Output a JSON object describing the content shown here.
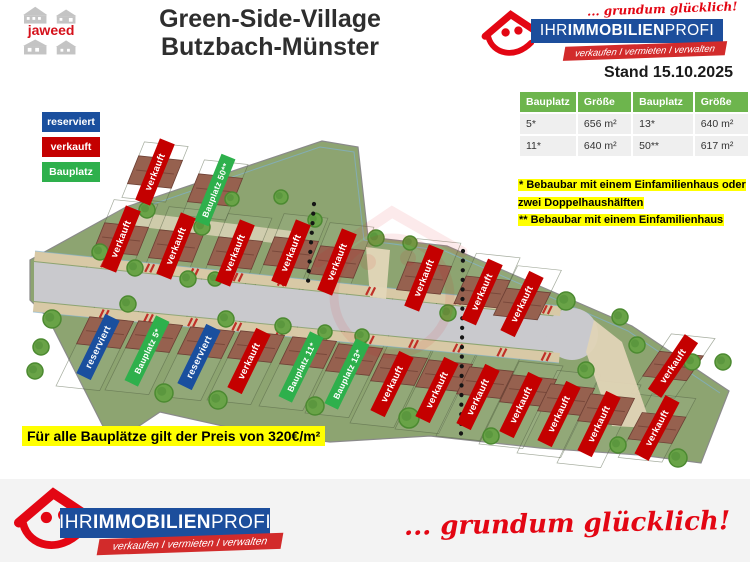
{
  "header": {
    "logo_text": "jaweed",
    "title_line1": "Green-Side-Village",
    "title_line2": "Butzbach-Münster",
    "stand": "Stand 15.10.2025"
  },
  "brand": {
    "slogan": "... grundum glücklich!",
    "name_prefix": "IHR ",
    "name_bold": "IMMOBILIEN",
    "name_suffix": "PROFI",
    "ribbon": "verkaufen I vermieten I verwalten"
  },
  "legend": {
    "items": [
      {
        "label": "reserviert",
        "color": "#1a4f9e"
      },
      {
        "label": "verkauft",
        "color": "#c40000"
      },
      {
        "label": "Bauplatz",
        "color": "#2eb04c"
      }
    ]
  },
  "table": {
    "headers": [
      "Bauplatz",
      "Größe",
      "Bauplatz",
      "Größe"
    ],
    "rows": [
      [
        "5*",
        "656 m²",
        "13*",
        "640 m²"
      ],
      [
        "11*",
        "640 m²",
        "50**",
        "617 m²"
      ]
    ],
    "header_color": "#6db54d"
  },
  "notes": [
    "* Bebaubar mit einem Einfamilienhaus oder zwei Doppelhaushälften",
    "** Bebaubar mit einem Einfamilienhaus"
  ],
  "price_note": "Für alle Bauplätze gilt der Preis von 320€/m²",
  "colors": {
    "brand_blue": "#1c4e9c",
    "brand_red": "#e30613",
    "sold": "#c40000",
    "reserved": "#1a4f9e",
    "available": "#2eb04c",
    "highlight": "#ffff00"
  },
  "map": {
    "plots": [
      {
        "label": "verkauft",
        "status": "verkauft",
        "x": 155,
        "y": 172,
        "rot": -68
      },
      {
        "label": "Bauplatz 50**",
        "status": "frei",
        "x": 215,
        "y": 190,
        "rot": -68
      },
      {
        "label": "verkauft",
        "status": "verkauft",
        "x": 121,
        "y": 239,
        "rot": -68
      },
      {
        "label": "verkauft",
        "status": "verkauft",
        "x": 176,
        "y": 246,
        "rot": -68
      },
      {
        "label": "verkauft",
        "status": "verkauft",
        "x": 235,
        "y": 253,
        "rot": -68
      },
      {
        "label": "verkauft",
        "status": "verkauft",
        "x": 291,
        "y": 253,
        "rot": -68
      },
      {
        "label": "verkauft",
        "status": "verkauft",
        "x": 337,
        "y": 262,
        "rot": -68
      },
      {
        "label": "verkauft",
        "status": "verkauft",
        "x": 424,
        "y": 278,
        "rot": -68
      },
      {
        "label": "verkauft",
        "status": "verkauft",
        "x": 482,
        "y": 292,
        "rot": -66
      },
      {
        "label": "verkauft",
        "status": "verkauft",
        "x": 522,
        "y": 304,
        "rot": -64
      },
      {
        "label": "verkauft",
        "status": "verkauft",
        "x": 673,
        "y": 366,
        "rot": -56
      },
      {
        "label": "verkauft",
        "status": "verkauft",
        "x": 657,
        "y": 428,
        "rot": -62
      },
      {
        "label": "reserviert",
        "status": "reserviert",
        "x": 98,
        "y": 347,
        "rot": -64
      },
      {
        "label": "Bauplatz 5*",
        "status": "frei",
        "x": 147,
        "y": 351,
        "rot": -64
      },
      {
        "label": "reserviert",
        "status": "reserviert",
        "x": 199,
        "y": 357,
        "rot": -64
      },
      {
        "label": "verkauft",
        "status": "verkauft",
        "x": 249,
        "y": 361,
        "rot": -64
      },
      {
        "label": "Bauplatz 11*",
        "status": "frei",
        "x": 301,
        "y": 367,
        "rot": -64
      },
      {
        "label": "Bauplatz 13*",
        "status": "frei",
        "x": 347,
        "y": 374,
        "rot": -64
      },
      {
        "label": "verkauft",
        "status": "verkauft",
        "x": 392,
        "y": 384,
        "rot": -64
      },
      {
        "label": "verkauft",
        "status": "verkauft",
        "x": 437,
        "y": 390,
        "rot": -64
      },
      {
        "label": "verkauft",
        "status": "verkauft",
        "x": 478,
        "y": 397,
        "rot": -64
      },
      {
        "label": "verkauft",
        "status": "verkauft",
        "x": 521,
        "y": 405,
        "rot": -64
      },
      {
        "label": "verkauft",
        "status": "verkauft",
        "x": 559,
        "y": 414,
        "rot": -64
      },
      {
        "label": "verkauft",
        "status": "verkauft",
        "x": 599,
        "y": 424,
        "rot": -64
      }
    ]
  }
}
